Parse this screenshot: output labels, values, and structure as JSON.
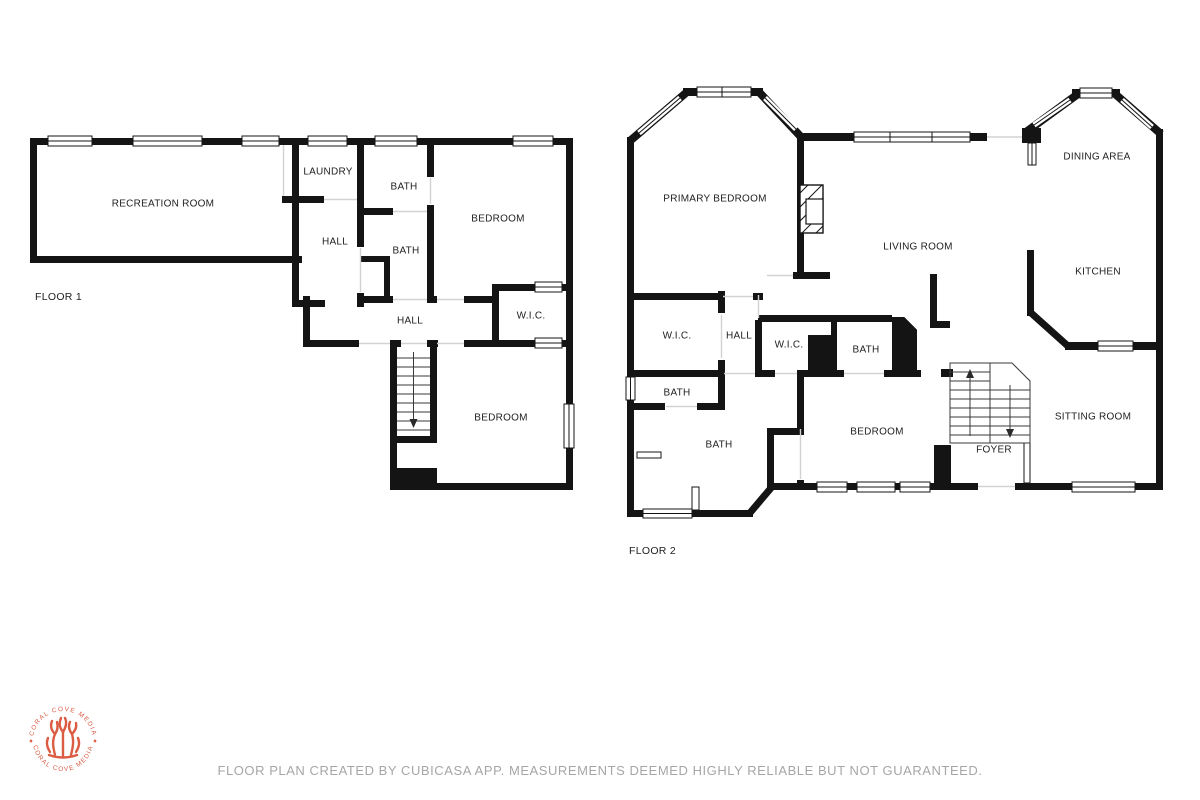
{
  "page": {
    "footer_disclaimer": "FLOOR PLAN CREATED BY CUBICASA APP. MEASUREMENTS DEEMED HIGHLY RELIABLE BUT NOT GUARANTEED."
  },
  "branding": {
    "name_top_arc": "CORAL COVE MEDIA",
    "name_bottom_arc": "CORAL COVE MEDIA",
    "color": "#db5b43"
  },
  "floor1": {
    "title": "FLOOR 1",
    "rooms": {
      "recreation_room": "RECREATION ROOM",
      "laundry": "LAUNDRY",
      "hall_upper": "HALL",
      "bath_top": "BATH",
      "bath_middle": "BATH",
      "bedroom_upper": "BEDROOM",
      "wic": "W.I.C.",
      "hall_lower": "HALL",
      "bedroom_lower": "BEDROOM"
    }
  },
  "floor2": {
    "title": "FLOOR 2",
    "rooms": {
      "primary_bedroom": "PRIMARY BEDROOM",
      "living_room": "LIVING ROOM",
      "dining_area": "DINING AREA",
      "kitchen": "KITCHEN",
      "wic_left": "W.I.C.",
      "hall": "HALL",
      "wic_middle": "W.I.C.",
      "bath_upper": "BATH",
      "bath_left": "BATH",
      "bath_lower": "BATH",
      "bedroom": "BEDROOM",
      "sitting_room": "SITTING ROOM",
      "foyer": "FOYER"
    }
  }
}
